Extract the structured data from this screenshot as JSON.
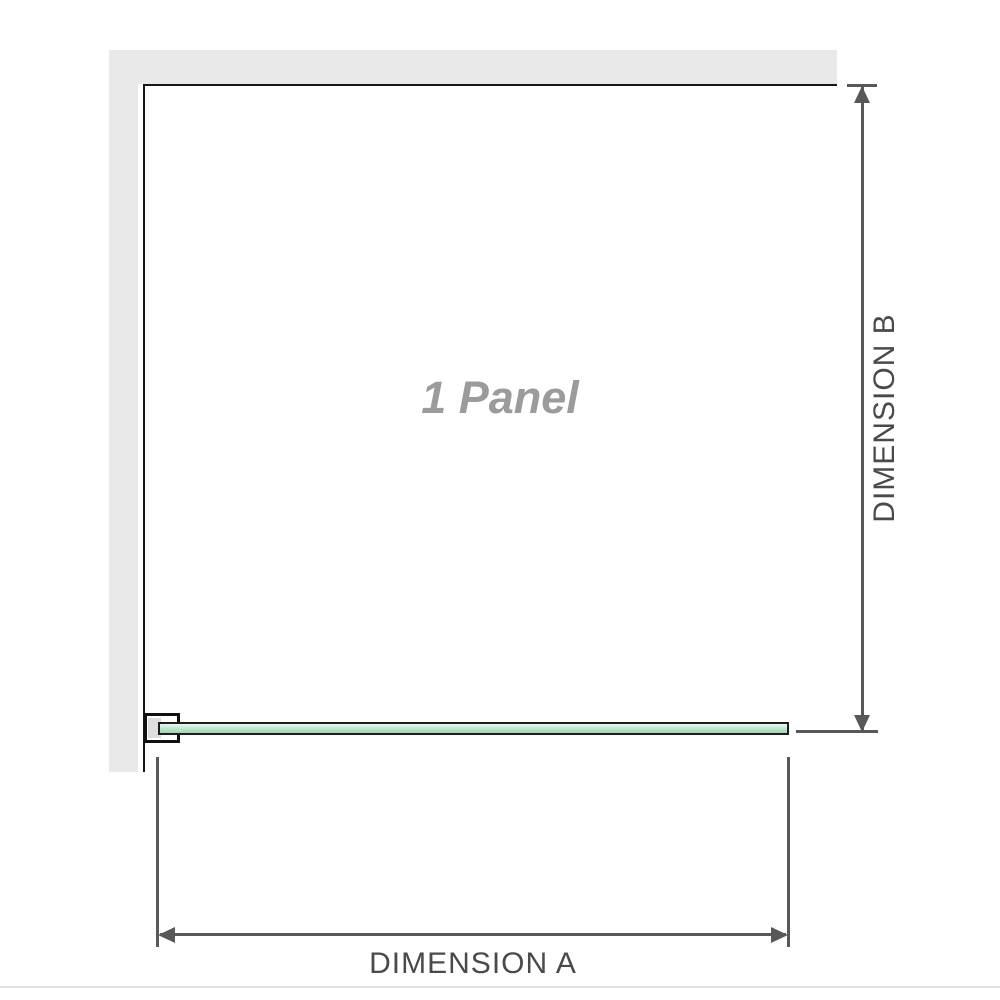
{
  "diagram": {
    "panel_label": "1 Panel",
    "dimension_a_label": "DIMENSION A",
    "dimension_b_label": "DIMENSION B"
  },
  "colors": {
    "wall": "#e9e9e9",
    "panel_outline": "#161616",
    "glass_light": "#eef8f2",
    "glass_dark": "#9fd6b5",
    "glass_border": "#1d1d1d",
    "bracket_border": "#111111",
    "bracket_pad": "#dedede",
    "dimension_line": "#58585a",
    "dimension_label_text": "#4a4a4a",
    "watermark_text": "#9b9b9b",
    "footer_divider": "#e2e2e2"
  }
}
